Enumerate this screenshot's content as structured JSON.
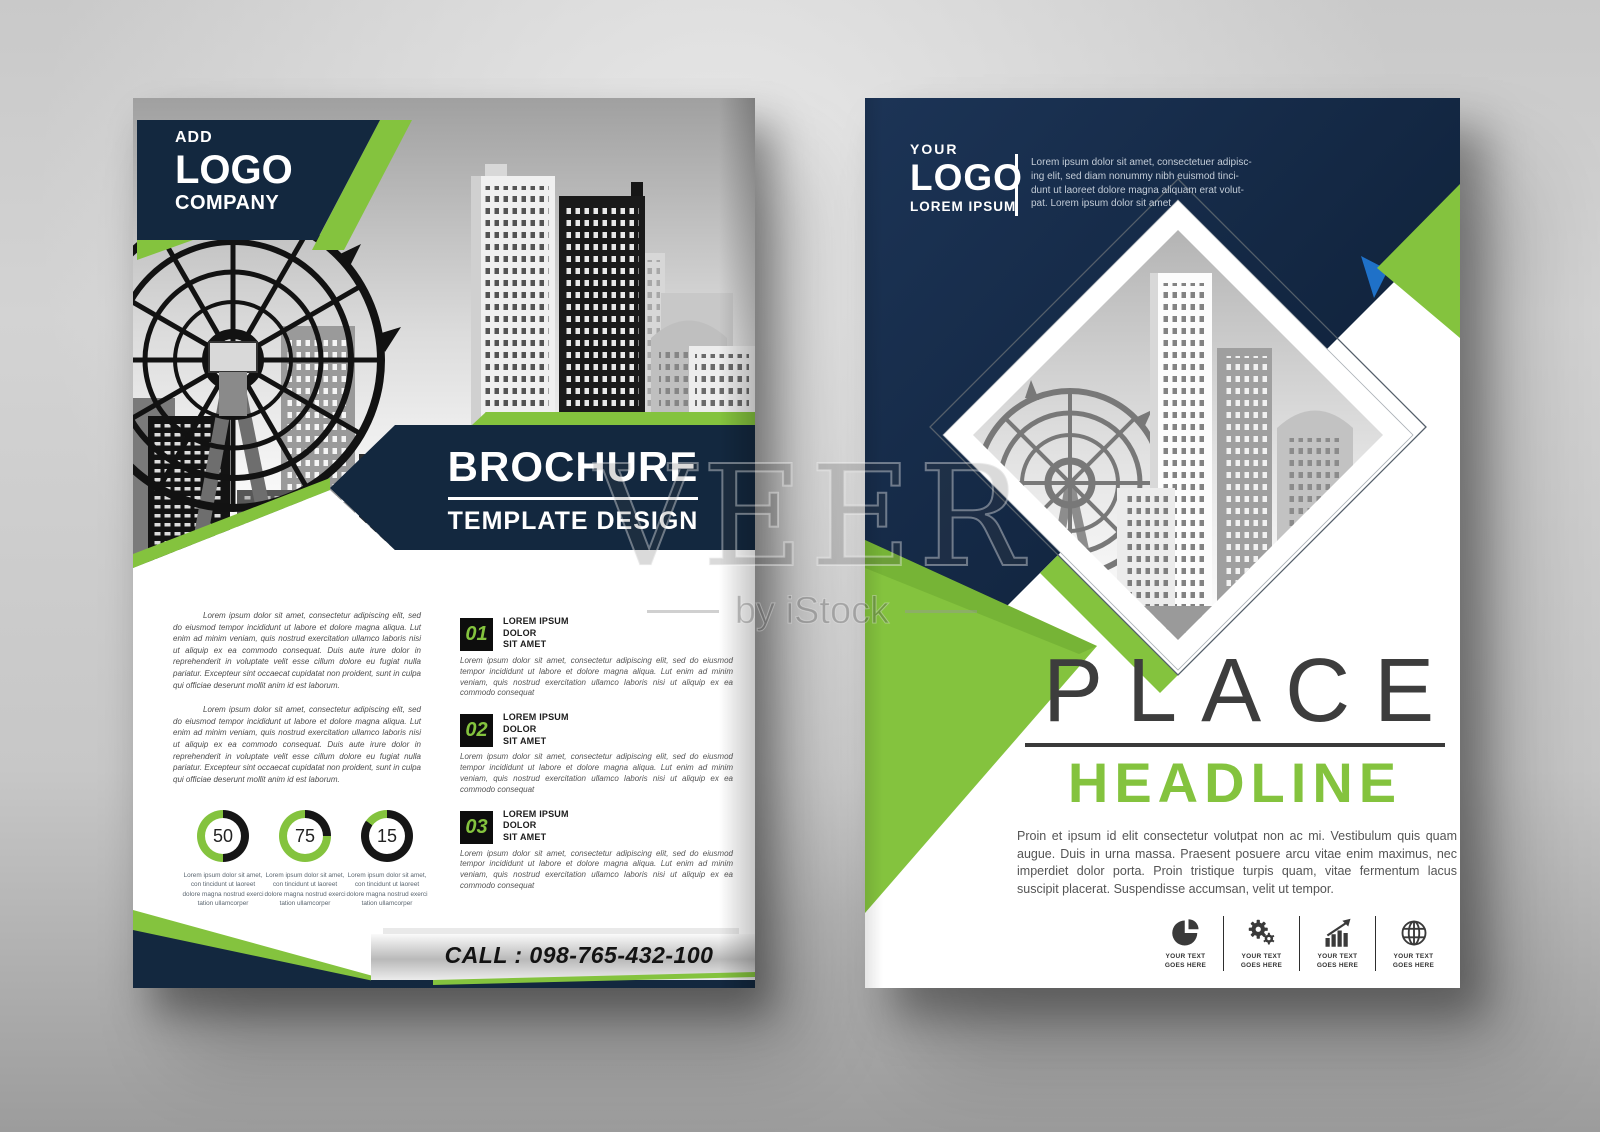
{
  "colors": {
    "green": "#84c33e",
    "navy": "#13283f",
    "blue": "#1f71c8",
    "dark_text": "#3a3a3a"
  },
  "watermark": {
    "brand": "VEER",
    "byline": "by iStock"
  },
  "left_page": {
    "logo": {
      "line1": "ADD",
      "line2": "LOGO",
      "line3": "COMPANY"
    },
    "title": {
      "main": "BROCHURE",
      "sub": "TEMPLATE DESIGN"
    },
    "intro_paragraphs": [
      "Lorem ipsum dolor sit amet, consectetur adipiscing elit, sed do eiusmod tempor incididunt ut labore et dolore magna aliqua. Lut enim ad minim veniam, quis nostrud exercitation ullamco laboris nisi ut aliquip ex ea commodo consequat. Duis aute irure dolor in reprehenderit in voluptate velit esse cillum dolore eu fugiat nulla pariatur. Excepteur sint occaecat cupidatat non proident, sunt in culpa qui officiae deserunt mollit anim id est laborum.",
      "Lorem ipsum dolor sit amet, consectetur adipiscing elit, sed do eiusmod tempor incididunt ut labore et dolore magna aliqua. Lut enim ad minim veniam, quis nostrud exercitation ullamco laboris nisi ut aliquip ex ea commodo consequat. Duis aute irure dolor in reprehenderit in voluptate velit esse cillum dolore eu fugiat nulla pariatur. Excepteur sint occaecat cupidatat non proident, sunt in culpa qui officiae deserunt mollit anim id est laborum."
    ],
    "items": [
      {
        "number": "01",
        "heading_lines": [
          "LOREM IPSUM",
          "DOLOR",
          "SIT AMET"
        ],
        "body": "Lorem ipsum dolor sit amet, consectetur adipiscing elit, sed do eiusmod tempor incididunt ut labore et dolore magna aliqua. Lut enim ad minim veniam, quis nostrud exercitation ullamco laboris nisi ut aliquip ex ea commodo consequat"
      },
      {
        "number": "02",
        "heading_lines": [
          "LOREM IPSUM",
          "DOLOR",
          "SIT AMET"
        ],
        "body": "Lorem ipsum dolor sit amet, consectetur adipiscing elit, sed do eiusmod tempor incididunt ut labore et dolore magna aliqua. Lut enim ad minim veniam, quis nostrud exercitation ullamco laboris nisi ut aliquip ex ea commodo consequat"
      },
      {
        "number": "03",
        "heading_lines": [
          "LOREM IPSUM",
          "DOLOR",
          "SIT AMET"
        ],
        "body": "Lorem ipsum dolor sit amet, consectetur adipiscing elit, sed do eiusmod tempor incididunt ut labore et dolore magna aliqua. Lut enim ad minim veniam, quis nostrud exercitation ullamco laboris nisi ut aliquip ex ea commodo consequat"
      }
    ],
    "donuts": [
      {
        "value": 50,
        "caption": "Lorem ipsum dolor sit amet, con tincidunt ut laoreet dolore magna nostrud exerci tation ullamcorper"
      },
      {
        "value": 75,
        "caption": "Lorem ipsum dolor sit amet, con tincidunt ut laoreet dolore magna nostrud exerci tation ullamcorper"
      },
      {
        "value": 15,
        "caption": "Lorem ipsum dolor sit amet, con tincidunt ut laoreet dolore magna nostrud exerci tation ullamcorper"
      }
    ],
    "call_label": "CALL : 098-765-432-100"
  },
  "right_page": {
    "logo": {
      "line1": "YOUR",
      "line2": "LOGO",
      "line3": "LOREM IPSUM"
    },
    "intro_lines": [
      "Lorem ipsum dolor sit amet, consectetuer adipisc-",
      "ing elit, sed diam nonummy nibh euismod tinci-",
      "dunt ut laoreet dolore magna aliquam erat volut-",
      "pat. Lorem ipsum dolor sit amet"
    ],
    "headline": {
      "top": "PLACE",
      "bottom": "HEADLINE"
    },
    "body": "Proin et ipsum id elit consectetur volutpat non ac mi. Vestibulum quis quam augue. Duis in urna massa. Praesent posuere arcu vitae enim maximus, nec imperdiet dolor porta. Proin tristique turpis quam, vitae fermentum lacus suscipit placerat. Suspendisse accumsan, velit ut tempor.",
    "features": [
      {
        "icon": "pie-chart-icon",
        "label_lines": [
          "YOUR TEXT",
          "GOES HERE"
        ]
      },
      {
        "icon": "gears-icon",
        "label_lines": [
          "YOUR TEXT",
          "GOES HERE"
        ]
      },
      {
        "icon": "growth-chart-icon",
        "label_lines": [
          "YOUR TEXT",
          "GOES HERE"
        ]
      },
      {
        "icon": "globe-icon",
        "label_lines": [
          "YOUR TEXT",
          "GOES HERE"
        ]
      }
    ]
  }
}
